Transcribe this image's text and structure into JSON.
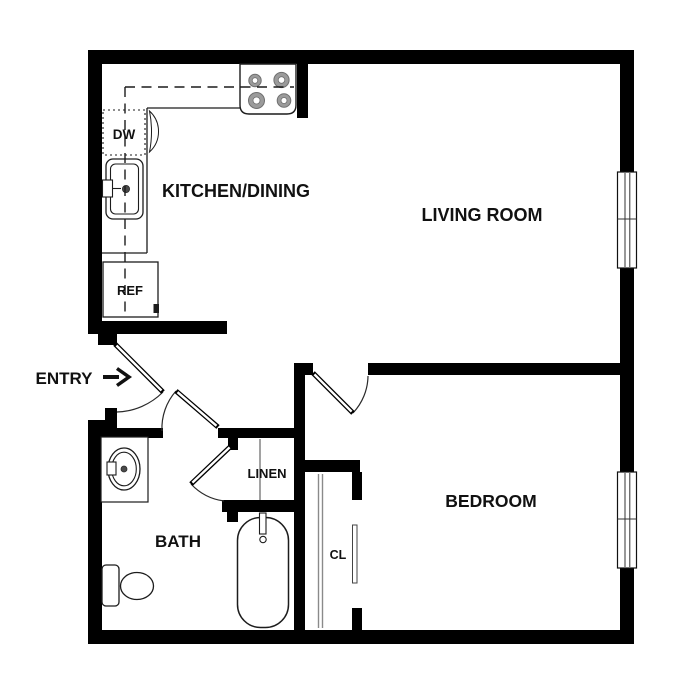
{
  "floorplan": {
    "rooms": {
      "kitchen_dining": "KITCHEN/DINING",
      "living_room": "LIVING ROOM",
      "bedroom": "BEDROOM",
      "bath": "BATH",
      "linen": "LINEN",
      "closet": "CL"
    },
    "appliances": {
      "dishwasher": "DW",
      "refrigerator": "REF"
    },
    "entry_label": "ENTRY",
    "colors": {
      "background": "#ffffff",
      "wall": "#000000",
      "fixture_line": "#1c1c1c",
      "burner": "#9b9b9b",
      "sliding_door": "#8a8a8a",
      "text": "#111111"
    }
  }
}
